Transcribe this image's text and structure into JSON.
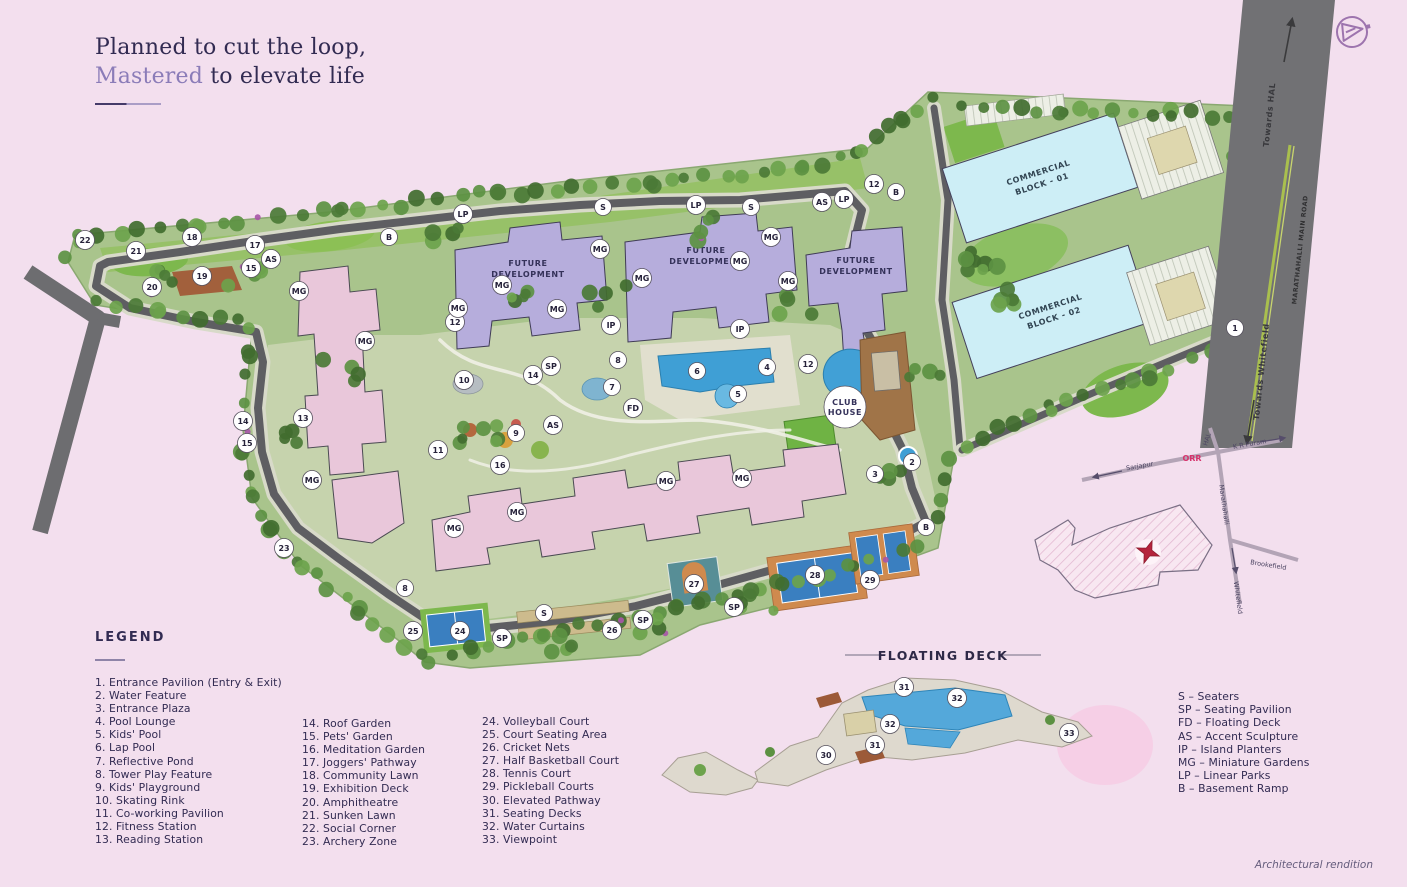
{
  "page": {
    "background": "#f3dfee",
    "footnote": "Architectural rendition"
  },
  "title": {
    "line1": "Planned to cut the loop,",
    "accent": "Mastered",
    "rest": " to elevate life"
  },
  "map": {
    "building_labels": {
      "future1_l1": "FUTURE",
      "future1_l2": "DEVELOPMENT",
      "future2_l1": "FUTURE",
      "future2_l2": "DEVELOPMENT",
      "future3_l1": "FUTURE",
      "future3_l2": "DEVELOPMENT",
      "commercial1_l1": "COMMERCIAL",
      "commercial1_l2": "BLOCK - 01",
      "commercial2_l1": "COMMERCIAL",
      "commercial2_l2": "BLOCK - 02",
      "club_l1": "CLUB",
      "club_l2": "HOUSE"
    },
    "road_labels": {
      "towards_hal": "Towards HAL",
      "main_road": "MARATHAHALLI MAIN ROAD",
      "towards_whitefield": "Towards Whitefield"
    },
    "markers": [
      {
        "label": "22",
        "x": 85,
        "y": 240
      },
      {
        "label": "21",
        "x": 136,
        "y": 251
      },
      {
        "label": "18",
        "x": 192,
        "y": 237
      },
      {
        "label": "17",
        "x": 255,
        "y": 245
      },
      {
        "label": "AS",
        "x": 271,
        "y": 259
      },
      {
        "label": "15",
        "x": 251,
        "y": 268
      },
      {
        "label": "19",
        "x": 202,
        "y": 276
      },
      {
        "label": "20",
        "x": 152,
        "y": 287
      },
      {
        "label": "MG",
        "x": 299,
        "y": 291
      },
      {
        "label": "B",
        "x": 389,
        "y": 237
      },
      {
        "label": "LP",
        "x": 463,
        "y": 214
      },
      {
        "label": "S",
        "x": 603,
        "y": 207
      },
      {
        "label": "LP",
        "x": 696,
        "y": 205
      },
      {
        "label": "S",
        "x": 751,
        "y": 207
      },
      {
        "label": "AS",
        "x": 822,
        "y": 202
      },
      {
        "label": "LP",
        "x": 844,
        "y": 199
      },
      {
        "label": "12",
        "x": 874,
        "y": 184
      },
      {
        "label": "B",
        "x": 896,
        "y": 192
      },
      {
        "label": "MG",
        "x": 365,
        "y": 341
      },
      {
        "label": "12",
        "x": 455,
        "y": 322
      },
      {
        "label": "10",
        "x": 464,
        "y": 380
      },
      {
        "label": "13",
        "x": 303,
        "y": 418
      },
      {
        "label": "14",
        "x": 243,
        "y": 421
      },
      {
        "label": "15",
        "x": 247,
        "y": 443
      },
      {
        "label": "MG",
        "x": 312,
        "y": 480
      },
      {
        "label": "23",
        "x": 284,
        "y": 548
      },
      {
        "label": "11",
        "x": 438,
        "y": 450
      },
      {
        "label": "16",
        "x": 500,
        "y": 465
      },
      {
        "label": "9",
        "x": 516,
        "y": 433
      },
      {
        "label": "AS",
        "x": 553,
        "y": 425
      },
      {
        "label": "SP",
        "x": 551,
        "y": 366
      },
      {
        "label": "14",
        "x": 533,
        "y": 375
      },
      {
        "label": "8",
        "x": 618,
        "y": 360
      },
      {
        "label": "7",
        "x": 612,
        "y": 387
      },
      {
        "label": "FD",
        "x": 633,
        "y": 408
      },
      {
        "label": "IP",
        "x": 611,
        "y": 325
      },
      {
        "label": "IP",
        "x": 740,
        "y": 329
      },
      {
        "label": "6",
        "x": 697,
        "y": 371
      },
      {
        "label": "4",
        "x": 767,
        "y": 367
      },
      {
        "label": "5",
        "x": 738,
        "y": 394
      },
      {
        "label": "12",
        "x": 808,
        "y": 364
      },
      {
        "label": "MG",
        "x": 458,
        "y": 308
      },
      {
        "label": "MG",
        "x": 502,
        "y": 285
      },
      {
        "label": "MG",
        "x": 557,
        "y": 309
      },
      {
        "label": "MG",
        "x": 600,
        "y": 249
      },
      {
        "label": "MG",
        "x": 642,
        "y": 278
      },
      {
        "label": "MG",
        "x": 740,
        "y": 261
      },
      {
        "label": "MG",
        "x": 771,
        "y": 237
      },
      {
        "label": "MG",
        "x": 788,
        "y": 281
      },
      {
        "label": "MG",
        "x": 454,
        "y": 528
      },
      {
        "label": "MG",
        "x": 517,
        "y": 512
      },
      {
        "label": "MG",
        "x": 666,
        "y": 481
      },
      {
        "label": "MG",
        "x": 742,
        "y": 478
      },
      {
        "label": "8",
        "x": 405,
        "y": 588
      },
      {
        "label": "25",
        "x": 413,
        "y": 631
      },
      {
        "label": "24",
        "x": 460,
        "y": 631
      },
      {
        "label": "SP",
        "x": 502,
        "y": 638
      },
      {
        "label": "S",
        "x": 544,
        "y": 613
      },
      {
        "label": "26",
        "x": 612,
        "y": 630
      },
      {
        "label": "SP",
        "x": 643,
        "y": 620
      },
      {
        "label": "27",
        "x": 694,
        "y": 584
      },
      {
        "label": "SP",
        "x": 734,
        "y": 607
      },
      {
        "label": "28",
        "x": 815,
        "y": 575
      },
      {
        "label": "29",
        "x": 870,
        "y": 580
      },
      {
        "label": "B",
        "x": 926,
        "y": 527
      },
      {
        "label": "2",
        "x": 912,
        "y": 462
      },
      {
        "label": "3",
        "x": 875,
        "y": 474
      },
      {
        "label": "1",
        "x": 1235,
        "y": 328
      }
    ]
  },
  "floating_deck": {
    "title": "FLOATING DECK",
    "markers": [
      {
        "label": "31",
        "x": 904,
        "y": 687
      },
      {
        "label": "32",
        "x": 957,
        "y": 698
      },
      {
        "label": "32",
        "x": 890,
        "y": 724
      },
      {
        "label": "31",
        "x": 875,
        "y": 745
      },
      {
        "label": "30",
        "x": 826,
        "y": 755
      },
      {
        "label": "33",
        "x": 1069,
        "y": 733
      }
    ]
  },
  "inset": {
    "labels": {
      "hal": "HAL",
      "kr_puram": "K R Puram",
      "orr": "ORR",
      "sarjapur": "Sarjapur",
      "marathahalli": "Marathahalli",
      "brookefield": "Brookefield",
      "whitefield": "Whitefield"
    }
  },
  "legend": {
    "heading": "LEGEND",
    "columns": [
      [
        "1. Entrance Pavilion (Entry & Exit)",
        "2. Water Feature",
        "3. Entrance Plaza",
        "4. Pool Lounge",
        "5. Kids' Pool",
        "6. Lap Pool",
        "7. Reflective Pond",
        "8. Tower Play Feature",
        "9. Kids' Playground",
        "10. Skating Rink",
        "11. Co-working Pavilion",
        "12. Fitness Station",
        "13. Reading Station"
      ],
      [
        "14. Roof Garden",
        "15. Pets' Garden",
        "16. Meditation Garden",
        "17. Joggers' Pathway",
        "18. Community Lawn",
        "19. Exhibition Deck",
        "20. Amphitheatre",
        "21. Sunken Lawn",
        "22. Social Corner",
        "23. Archery Zone"
      ],
      [
        "24. Volleyball Court",
        "25. Court Seating Area",
        "26. Cricket Nets",
        "27. Half Basketball Court",
        "28. Tennis Court",
        "29. Pickleball Courts",
        "30. Elevated Pathway",
        "31. Seating Decks",
        "32. Water Curtains",
        "33. Viewpoint"
      ]
    ],
    "abbreviations": [
      "S – Seaters",
      "SP – Seating Pavilion",
      "FD – Floating Deck",
      "AS – Accent Sculpture",
      "IP – Island Planters",
      "MG – Miniature Gardens",
      "LP – Linear Parks",
      "B – Basement Ramp"
    ]
  }
}
